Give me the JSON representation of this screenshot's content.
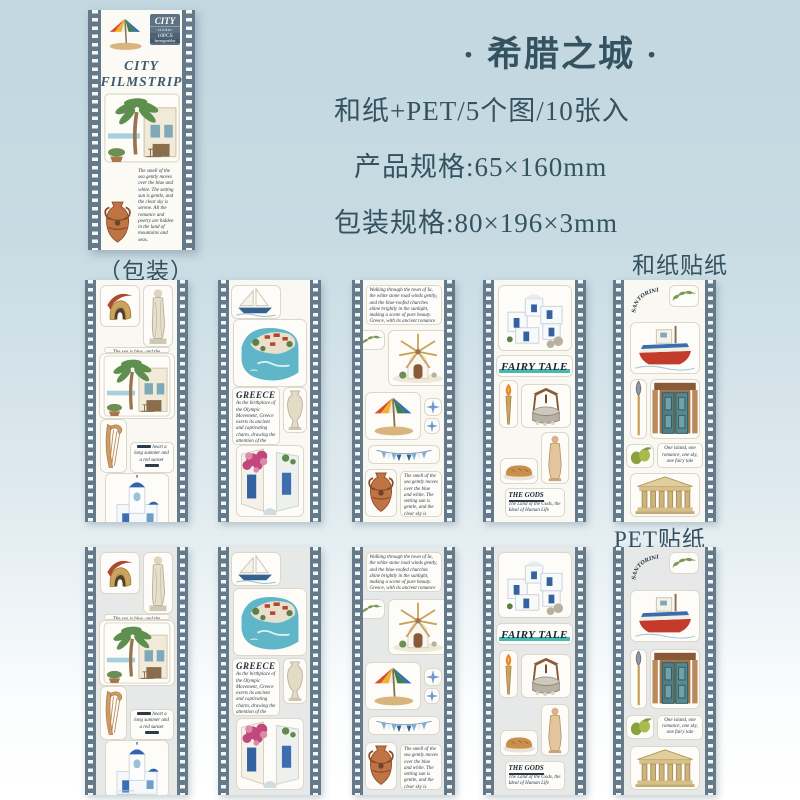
{
  "header": {
    "title": "· 希腊之城 ·",
    "line_material": "和纸+PET/5个图/10张入",
    "line_product_size": "产品规格:65×160mm",
    "line_package_size": "包装规格:80×196×3mm"
  },
  "labels": {
    "package_caption": "（包装）",
    "washi": "和纸贴纸",
    "pet": "PET贴纸"
  },
  "package": {
    "tag": {
      "title": "CITY",
      "subtitle": "·sticker·",
      "count": "10PCS",
      "brand": "haveagoodday"
    },
    "title_line1": "CITY",
    "title_line2": "FILMSTRIP",
    "body_text": "The smell of the sea gently moves over the blue and white. The setting sun is gentle, and the clear sky is serene. All the romance and poetry are hidden in the land of mountains and seas."
  },
  "strips": [
    {
      "name": "ancient",
      "texts": {
        "caption": "The sea is blue, and the dream is white.",
        "title": "ANCIENT",
        "side_note": "heart a long summer and a red sunset"
      }
    },
    {
      "name": "greece",
      "texts": {
        "title": "GREECE",
        "paragraph": "As the birthplace of the Olympic Movement, Greece exerts its ancient and captivating charm, drawing the attention of the entire world."
      }
    },
    {
      "name": "windmill",
      "texts": {
        "paragraph": "Walking through the town of Ia, the white stone road winds gently, and the blue-roofed churches shine brightly in the sunlight, making a scene of pure beauty. Greece, with its ancient romance and poetry, enchants every visitor and forgets to leave.",
        "body_text": "The smell of the sea gently moves over the blue and white. The setting sun is gentle, and the clear sky is serene. All the romance and poetry are hidden in the land of mountains and seas."
      }
    },
    {
      "name": "fairy-tale",
      "texts": {
        "title": "FAIRY TALE",
        "gods_title": "THE GODS",
        "gods_paragraph": "The Land of the Gods, the Ideal of Human Life"
      }
    },
    {
      "name": "santorini",
      "texts": {
        "arc_title": "SANTORINI",
        "note": "One island, one romance, one sky, one fairy tale"
      }
    }
  ],
  "colors": {
    "film_edge": "#64798a",
    "washi_backing": "#f9f8f3",
    "pet_backing": "#e7e9e9",
    "accent_teal": "#49b8b2",
    "header_text": "#34525f"
  }
}
